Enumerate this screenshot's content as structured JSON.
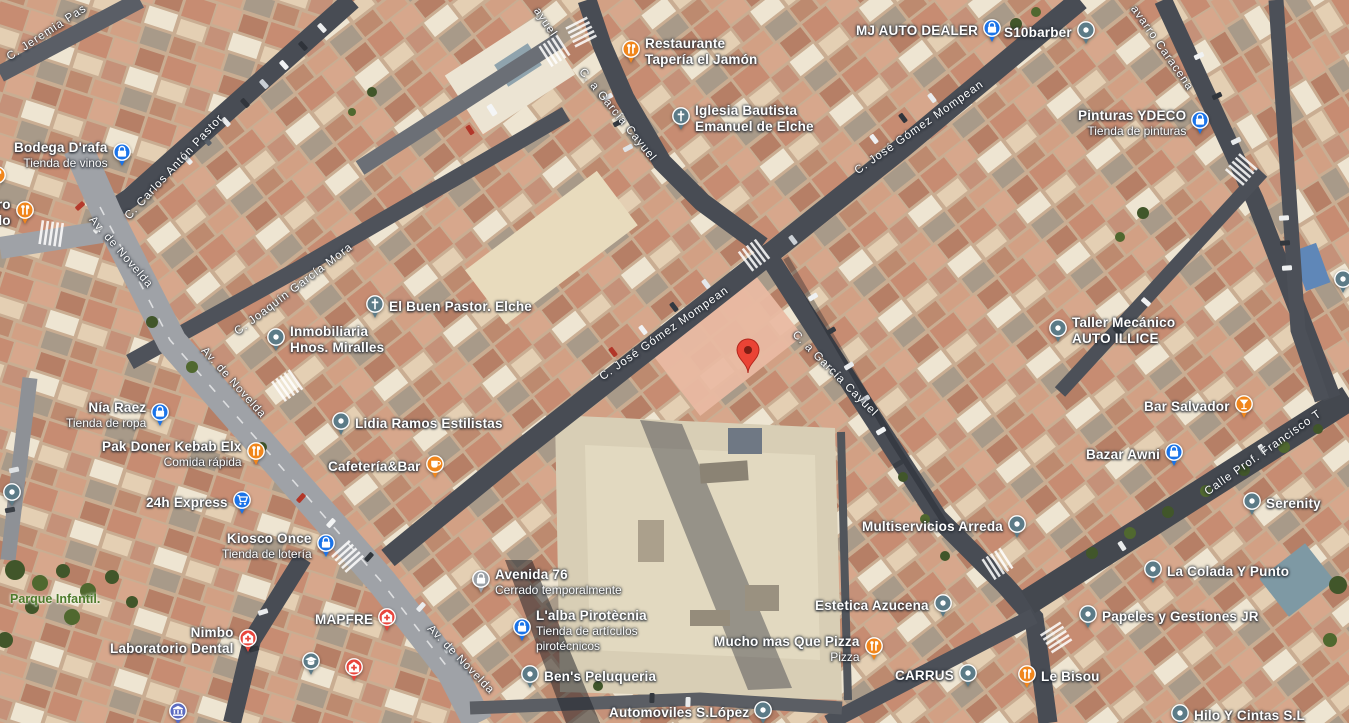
{
  "map": {
    "type": "satellite-view",
    "pin": {
      "x": 748,
      "y": 372,
      "label": "destination"
    },
    "colors": {
      "poi_blue": "#1a73e8",
      "poi_orange": "#f0861c",
      "poi_slate": "#5c7b87",
      "poi_red": "#e8453c",
      "poi_gray_closed": "#9aa0a6",
      "poi_indigo": "#5c6bc0",
      "pin_red": "#ea4335",
      "park_label_green": "#4e7a2b"
    }
  },
  "street_labels": [
    {
      "id": "jeremia-pastor",
      "text": "C. Jeremia Pas",
      "x": 8,
      "y": 52,
      "angle": -33
    },
    {
      "id": "carlos-anton-pastor",
      "text": "C. Carlos Antón Pastor",
      "x": 127,
      "y": 212,
      "angle": -47
    },
    {
      "id": "av-de-novelda-1",
      "text": "Av. de Novelda",
      "x": 91,
      "y": 212,
      "angle": 49
    },
    {
      "id": "joaquin-garcia-mora",
      "text": "C. Joaquín García Mora",
      "x": 236,
      "y": 327,
      "angle": -37
    },
    {
      "id": "av-de-novelda-2",
      "text": "Av. de Novelda",
      "x": 203,
      "y": 343,
      "angle": 48
    },
    {
      "id": "garcia-cayuel-partial",
      "text": "ayuel",
      "x": 536,
      "y": 3,
      "angle": 56
    },
    {
      "id": "garcia-cayuel-n",
      "text": "C. a García Cayuel",
      "x": 581,
      "y": 64,
      "angle": 51
    },
    {
      "id": "jose-gomez-mompean-c",
      "text": "C. José Gómez Mompean",
      "x": 601,
      "y": 372,
      "angle": -35
    },
    {
      "id": "garcia-cayuel-s",
      "text": "C. a García Cayuel",
      "x": 794,
      "y": 327,
      "angle": 45
    },
    {
      "id": "jose-gomez-mompean-ne",
      "text": "C. José Gómez Mompean",
      "x": 856,
      "y": 166,
      "angle": -35
    },
    {
      "id": "navarro-caracena",
      "text": "avarro Caracena",
      "x": 1133,
      "y": 1,
      "angle": 55
    },
    {
      "id": "calle-prof-francisco",
      "text": "Calle Prof. Francisco T",
      "x": 1206,
      "y": 487,
      "angle": -35
    },
    {
      "id": "av-de-novelda-3",
      "text": "Av. de Novelda",
      "x": 429,
      "y": 621,
      "angle": 46
    }
  ],
  "area_labels": [
    {
      "id": "parque-infantil",
      "text": "Parque Infantil.",
      "x": 10,
      "y": 592
    }
  ],
  "pois": [
    {
      "id": "bodega-drafa",
      "x": 14,
      "y": 140,
      "side": "right",
      "icon": "shopping-bag-icon",
      "color": "#1a73e8",
      "lines": [
        {
          "t": "Bodega D'rafa",
          "b": 1
        },
        {
          "t": "Tienda de vinos",
          "b": 0
        }
      ]
    },
    {
      "id": "asadero-pollo-partial",
      "x": -24,
      "y": 197,
      "side": "right",
      "icon": "restaurant-icon",
      "color": "#f0861c",
      "lines": [
        {
          "t": "ero",
          "b": 1
        },
        {
          "t": "Rollo",
          "b": 1
        }
      ]
    },
    {
      "id": "cropped-poi-left",
      "x": -12,
      "y": 166,
      "side": "none",
      "icon": "restaurant-icon",
      "color": "#f0861c",
      "lines": []
    },
    {
      "id": "restaurante-taperia-el-jamon",
      "x": 622,
      "y": 36,
      "side": "left",
      "icon": "restaurant-icon",
      "color": "#f0861c",
      "lines": [
        {
          "t": "Restaurante",
          "b": 1
        },
        {
          "t": "Tapería el Jamón",
          "b": 1
        }
      ]
    },
    {
      "id": "iglesia-bautista-emanuel",
      "x": 672,
      "y": 103,
      "side": "left",
      "icon": "church-icon",
      "color": "#5c7b87",
      "lines": [
        {
          "t": "Iglesia Bautista",
          "b": 1
        },
        {
          "t": "Emanuel de Elche",
          "b": 1
        }
      ]
    },
    {
      "id": "mj-auto-dealer",
      "x": 856,
      "y": 19,
      "side": "right",
      "icon": "shopping-bag-icon",
      "color": "#1a73e8",
      "lines": [
        {
          "t": "MJ AUTO DEALER",
          "b": 1
        }
      ]
    },
    {
      "id": "s10barber",
      "x": 1004,
      "y": 21,
      "side": "right",
      "icon": "generic-place-icon",
      "color": "#5c7b87",
      "lines": [
        {
          "t": "S10barber",
          "b": 1
        }
      ]
    },
    {
      "id": "pinturas-ydeco",
      "x": 1078,
      "y": 108,
      "side": "right",
      "icon": "shopping-bag-icon",
      "color": "#1a73e8",
      "lines": [
        {
          "t": "Pinturas YDECO",
          "b": 1
        },
        {
          "t": "Tienda de pinturas",
          "b": 0
        }
      ]
    },
    {
      "id": "el-buen-pastor-elche",
      "x": 366,
      "y": 295,
      "side": "left",
      "icon": "church-icon",
      "color": "#5c7b87",
      "lines": [
        {
          "t": "El Buen Pastor. Elche",
          "b": 1
        }
      ]
    },
    {
      "id": "inmobiliaria-hnos-miralles",
      "x": 267,
      "y": 324,
      "side": "left",
      "icon": "generic-place-icon",
      "color": "#5c7b87",
      "lines": [
        {
          "t": "Inmobiliaria",
          "b": 1
        },
        {
          "t": "Hnos. Miralles",
          "b": 1
        }
      ]
    },
    {
      "id": "nia-raez",
      "x": 66,
      "y": 400,
      "side": "right",
      "icon": "shopping-bag-icon",
      "color": "#1a73e8",
      "lines": [
        {
          "t": "Nía Raez",
          "b": 1
        },
        {
          "t": "Tienda de ropa",
          "b": 0
        }
      ]
    },
    {
      "id": "pak-doner-kebab-elx",
      "x": 102,
      "y": 439,
      "side": "right",
      "icon": "restaurant-icon",
      "color": "#f0861c",
      "lines": [
        {
          "t": "Pak Doner Kebab Elx",
          "b": 1
        },
        {
          "t": "Comida rápida",
          "b": 0
        }
      ]
    },
    {
      "id": "lidia-ramos-estilistas",
      "x": 332,
      "y": 412,
      "side": "left",
      "icon": "generic-place-icon",
      "color": "#5c7b87",
      "lines": [
        {
          "t": "Lidia Ramos Estilistas",
          "b": 1
        }
      ]
    },
    {
      "id": "cafeteria-bar",
      "x": 328,
      "y": 455,
      "side": "right",
      "icon": "cafe-icon",
      "color": "#f0861c",
      "lines": [
        {
          "t": "Cafetería&Bar",
          "b": 1
        }
      ]
    },
    {
      "id": "24h-express",
      "x": 146,
      "y": 491,
      "side": "right",
      "icon": "shopping-cart-icon",
      "color": "#1a73e8",
      "lines": [
        {
          "t": "24h Express",
          "b": 1
        }
      ]
    },
    {
      "id": "kiosco-once",
      "x": 222,
      "y": 531,
      "side": "right",
      "icon": "shopping-bag-icon",
      "color": "#1a73e8",
      "lines": [
        {
          "t": "Kiosco Once",
          "b": 1
        },
        {
          "t": "Tienda de lotería",
          "b": 0
        }
      ]
    },
    {
      "id": "unlabeled-place-w",
      "x": 3,
      "y": 483,
      "side": "none",
      "icon": "generic-place-icon",
      "color": "#5c7b87",
      "lines": []
    },
    {
      "id": "taller-mecanico-auto-illice",
      "x": 1049,
      "y": 315,
      "side": "left",
      "icon": "generic-place-icon",
      "color": "#5c7b87",
      "lines": [
        {
          "t": "Taller Mecánico",
          "b": 1
        },
        {
          "t": "AUTO ILLICE",
          "b": 1
        }
      ]
    },
    {
      "id": "bar-salvador",
      "x": 1144,
      "y": 395,
      "side": "right",
      "icon": "bar-icon",
      "color": "#f0861c",
      "lines": [
        {
          "t": "Bar Salvador",
          "b": 1
        }
      ]
    },
    {
      "id": "bazar-awni",
      "x": 1086,
      "y": 443,
      "side": "right",
      "icon": "shopping-bag-icon",
      "color": "#1a73e8",
      "lines": [
        {
          "t": "Bazar Awni",
          "b": 1
        }
      ]
    },
    {
      "id": "serenity",
      "x": 1243,
      "y": 492,
      "side": "left",
      "icon": "generic-place-icon",
      "color": "#5c7b87",
      "lines": [
        {
          "t": "Serenity",
          "b": 1
        }
      ]
    },
    {
      "id": "multiservicios-arreda",
      "x": 862,
      "y": 515,
      "side": "right",
      "icon": "generic-place-icon",
      "color": "#5c7b87",
      "lines": [
        {
          "t": "Multiservicios Arreda",
          "b": 1
        }
      ]
    },
    {
      "id": "la-colada-y-punto",
      "x": 1144,
      "y": 560,
      "side": "left",
      "icon": "generic-place-icon",
      "color": "#5c7b87",
      "lines": [
        {
          "t": "La Colada Y Punto",
          "b": 1
        }
      ]
    },
    {
      "id": "papeles-y-gestiones-jr",
      "x": 1079,
      "y": 605,
      "side": "left",
      "icon": "generic-place-icon",
      "color": "#5c7b87",
      "lines": [
        {
          "t": "Papeles y Gestiones JR",
          "b": 1
        }
      ]
    },
    {
      "id": "estetica-azucena",
      "x": 815,
      "y": 594,
      "side": "right",
      "icon": "generic-place-icon",
      "color": "#5c7b87",
      "lines": [
        {
          "t": "Estetica Azucena",
          "b": 1
        }
      ]
    },
    {
      "id": "mucho-mas-que-pizza",
      "x": 714,
      "y": 634,
      "side": "right",
      "icon": "restaurant-icon",
      "color": "#f0861c",
      "lines": [
        {
          "t": "Mucho mas Que Pizza",
          "b": 1
        },
        {
          "t": "Pizza",
          "b": 0
        }
      ]
    },
    {
      "id": "avenida-76",
      "x": 472,
      "y": 567,
      "side": "left",
      "icon": "shopping-bag-icon",
      "color": "#9aa0a6",
      "lines": [
        {
          "t": "Avenida 76",
          "b": 1
        },
        {
          "t": "Cerrado temporalmente",
          "b": 0
        }
      ]
    },
    {
      "id": "lalba-pirotecnia",
      "x": 513,
      "y": 608,
      "side": "left",
      "icon": "shopping-bag-icon",
      "color": "#1a73e8",
      "lines": [
        {
          "t": "L'alba Pirotècnia",
          "b": 1
        },
        {
          "t": "Tienda de artículos",
          "b": 0
        },
        {
          "t": "pirotécnicos",
          "b": 0
        }
      ]
    },
    {
      "id": "bens-peluqueria",
      "x": 521,
      "y": 665,
      "side": "left",
      "icon": "generic-place-icon",
      "color": "#5c7b87",
      "lines": [
        {
          "t": "Ben's Peluqueria",
          "b": 1
        }
      ]
    },
    {
      "id": "nimbo-laboratorio-dental",
      "x": 110,
      "y": 625,
      "side": "right",
      "icon": "hospital-icon",
      "color": "#e8453c",
      "lines": [
        {
          "t": "Nimbo",
          "b": 1
        },
        {
          "t": "Laboratorio Dental",
          "b": 1
        }
      ]
    },
    {
      "id": "mapfre",
      "x": 315,
      "y": 608,
      "side": "right",
      "icon": "hospital-icon",
      "color": "#e8453c",
      "lines": [
        {
          "t": "MAPFRE",
          "b": 1
        }
      ]
    },
    {
      "id": "unlabeled-health",
      "x": 345,
      "y": 658,
      "side": "none",
      "icon": "hospital-icon",
      "color": "#e8453c",
      "lines": []
    },
    {
      "id": "unlabeled-school",
      "x": 302,
      "y": 652,
      "side": "none",
      "icon": "school-icon",
      "color": "#5c7b87",
      "lines": []
    },
    {
      "id": "unlabeled-bank",
      "x": 169,
      "y": 702,
      "side": "none",
      "icon": "bank-icon",
      "color": "#5c6bc0",
      "lines": []
    },
    {
      "id": "carrus",
      "x": 895,
      "y": 664,
      "side": "right",
      "icon": "generic-place-icon",
      "color": "#5c7b87",
      "lines": [
        {
          "t": "CARRUS",
          "b": 1
        }
      ]
    },
    {
      "id": "le-bisou",
      "x": 1018,
      "y": 665,
      "side": "left",
      "icon": "restaurant-icon",
      "color": "#f0861c",
      "lines": [
        {
          "t": "Le Bisou",
          "b": 1
        }
      ]
    },
    {
      "id": "automoviles-s-lopez",
      "x": 609,
      "y": 701,
      "side": "right",
      "icon": "generic-place-icon",
      "color": "#5c7b87",
      "lines": [
        {
          "t": "Automoviles S.López",
          "b": 1
        }
      ]
    },
    {
      "id": "hilo-y-cintas",
      "x": 1171,
      "y": 704,
      "side": "left",
      "icon": "generic-place-icon",
      "color": "#5c7b87",
      "lines": [
        {
          "t": "Hilo Y Cintas S.L",
          "b": 1
        }
      ]
    },
    {
      "id": "unlabeled-place-e",
      "x": 1334,
      "y": 270,
      "side": "none",
      "icon": "generic-place-icon",
      "color": "#5c7b87",
      "lines": []
    }
  ]
}
